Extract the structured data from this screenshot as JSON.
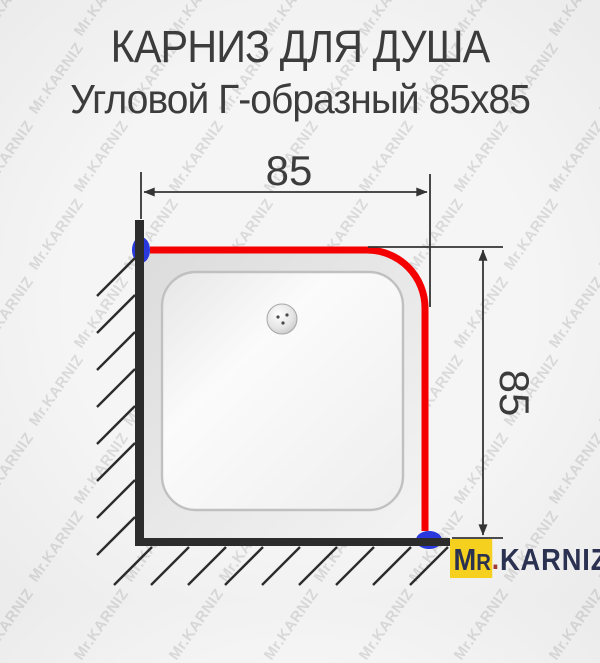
{
  "title": {
    "line1": "КАРНИЗ ДЛЯ ДУША",
    "line2": "Угловой Г-образный 85х85"
  },
  "diagram": {
    "dim_top": {
      "label": "85"
    },
    "dim_right": {
      "label": "85"
    }
  },
  "watermark": {
    "text": "Mr.KARNIZ"
  },
  "logo": {
    "m": "M",
    "r": "R",
    "dot": ".",
    "name": "KARNIZ"
  },
  "colors": {
    "bg": "#f5f5f5",
    "title_color": "#3c3c3c",
    "line_dark": "#343434",
    "wall_dark": "#2c2c2c",
    "rod_red": "#f50000",
    "mount_blue": "#2939dd",
    "tray_edge": "#c0c0c0",
    "logo_yellow": "#f6d01e",
    "logo_navy": "#2b3150",
    "logo_dot": "#a03a30",
    "watermark_gray": "rgba(110,110,110,0.20)"
  }
}
